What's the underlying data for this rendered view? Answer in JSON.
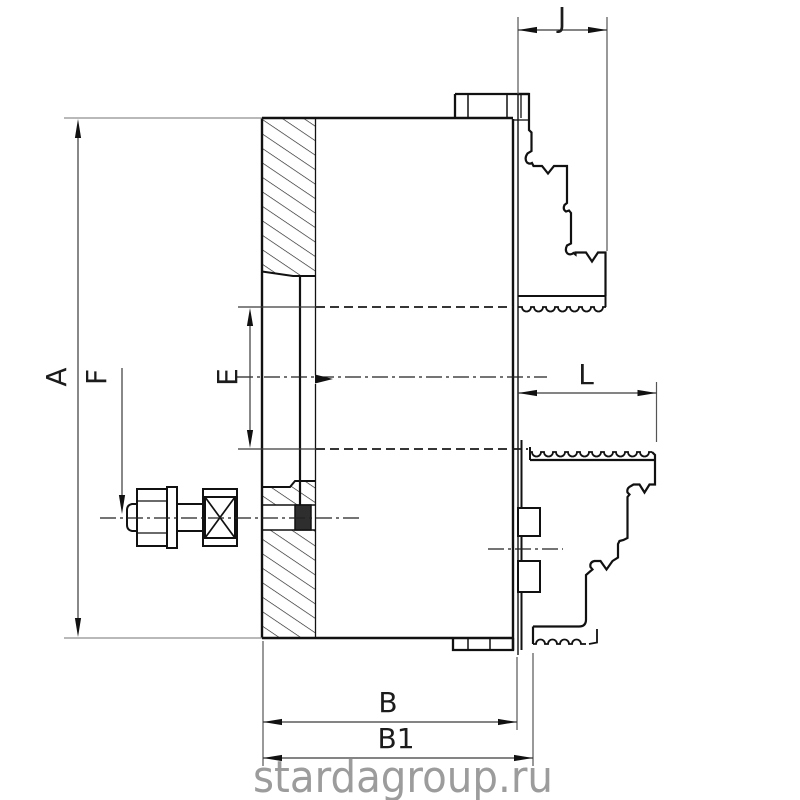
{
  "drawing": {
    "description": "engineering cross-section drawing of a lathe chuck with stepped jaws",
    "watermark": "stardagroup.ru",
    "labels": {
      "A": "A",
      "F": "F",
      "E": "E",
      "J": "J",
      "L": "L",
      "B": "B",
      "B1": "B1"
    },
    "colors": {
      "part_line": "#111111",
      "dimension_line": "#3a3a3a",
      "extension_line": "#8f8f8f",
      "watermark": "#9c9c9c",
      "background": "#ffffff"
    }
  }
}
